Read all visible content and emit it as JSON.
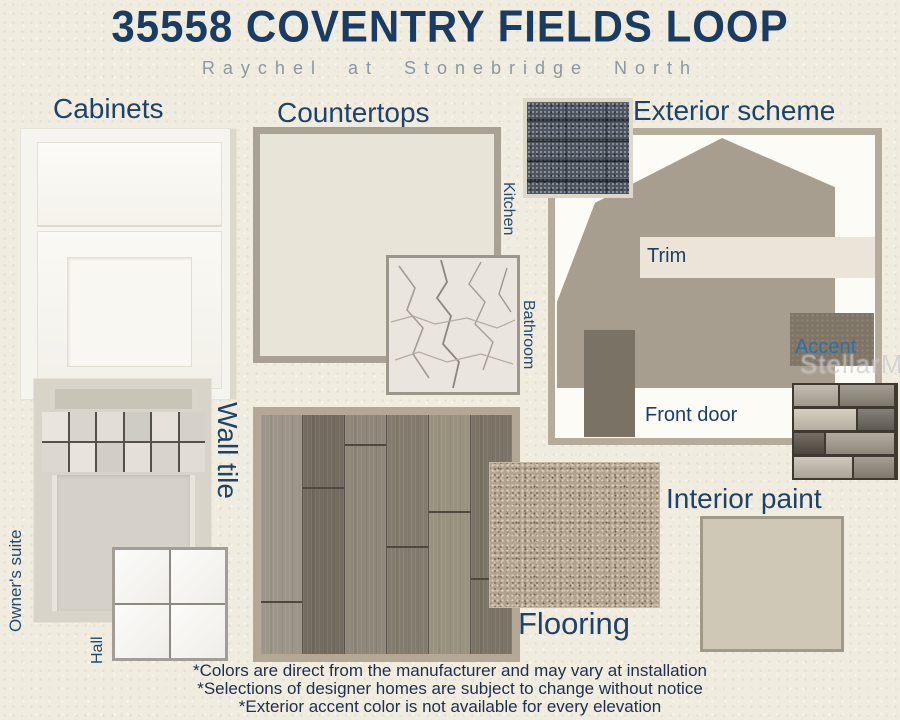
{
  "header": {
    "title": "35558 COVENTRY FIELDS LOOP",
    "subtitle": "Raychel at Stonebridge North"
  },
  "sections": {
    "cabinets": {
      "label": "Cabinets"
    },
    "countertops": {
      "label": "Countertops",
      "kitchen": "Kitchen",
      "bathroom": "Bathroom"
    },
    "exterior": {
      "label": "Exterior scheme",
      "trim": "Trim",
      "accent": "Accent",
      "front_door": "Front door"
    },
    "wall_tile": {
      "label": "Wall tile",
      "owners_suite": "Owner's suite",
      "hall": "Hall"
    },
    "flooring": {
      "label": "Flooring"
    },
    "interior_paint": {
      "label": "Interior paint"
    }
  },
  "watermark": {
    "text": "StellarMLS"
  },
  "footnotes": [
    "*Colors are direct from the manufacturer and may vary at installation",
    "*Selections of designer homes are subject to change without notice",
    "*Exterior accent color is not available for every elevation"
  ],
  "colors": {
    "title_navy": "#1b3c62",
    "section_label_navy": "#1e4268",
    "accent_label_blue": "#2f6ea6",
    "house_body": "#a89e8f",
    "trim": "#eae5d8",
    "front_door": "#7b7266",
    "exterior_accent": "#7e7567",
    "roof_shingle": "#4d565f",
    "kitchen_countertop": "#e8e4d7",
    "interior_paint": "#cfc8b6",
    "carpet": "#b2a290",
    "page_background": "#f0ecdf"
  }
}
